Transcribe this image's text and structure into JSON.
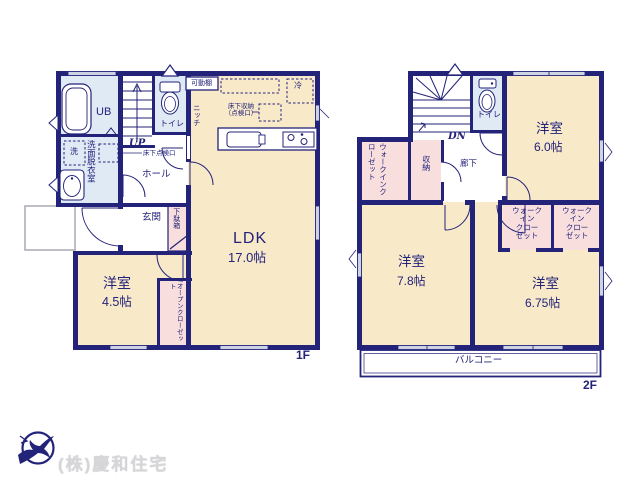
{
  "f1": {
    "tag": "1F",
    "ub": "UB",
    "senmen": "洗面脱衣室",
    "wash": "洗",
    "toilet": "トイレ",
    "up": "UP",
    "tenkenko": "床下点検口",
    "hall": "ホール",
    "kadodana": "可動棚",
    "niche": "ニッチ",
    "yukashita": "床下収納\n（点検口）",
    "rei": "冷",
    "genkan": "玄関",
    "getabako": "下駄箱",
    "open_closet": "オープンクローゼット",
    "ldk_name": "LDK",
    "ldk_size": "17.0帖",
    "bed_name": "洋室",
    "bed_size": "4.5帖"
  },
  "f2": {
    "tag": "2F",
    "dn": "DN",
    "toilet": "トイレ",
    "rouka": "廊下",
    "shuno": "収納",
    "wic": "ウォークインクローゼット",
    "wic_block": "ウォーク\nイン\nクロー\nゼット",
    "bed60_name": "洋室",
    "bed60_size": "6.0帖",
    "bed78_name": "洋室",
    "bed78_size": "7.8帖",
    "bed675_name": "洋室",
    "bed675_size": "6.75帖",
    "balcony": "バルコニー"
  },
  "logo": {
    "company": "(株)慶和住宅"
  },
  "colors": {
    "wall": "#23237a",
    "room_cream": "#f8e9c9",
    "wet_blue": "#dfeaf5",
    "closet_pink": "#f9dede",
    "window_gray": "#cdd3e3",
    "porch_gray": "#a9aab4",
    "logo_text": "#d6d6d8"
  }
}
